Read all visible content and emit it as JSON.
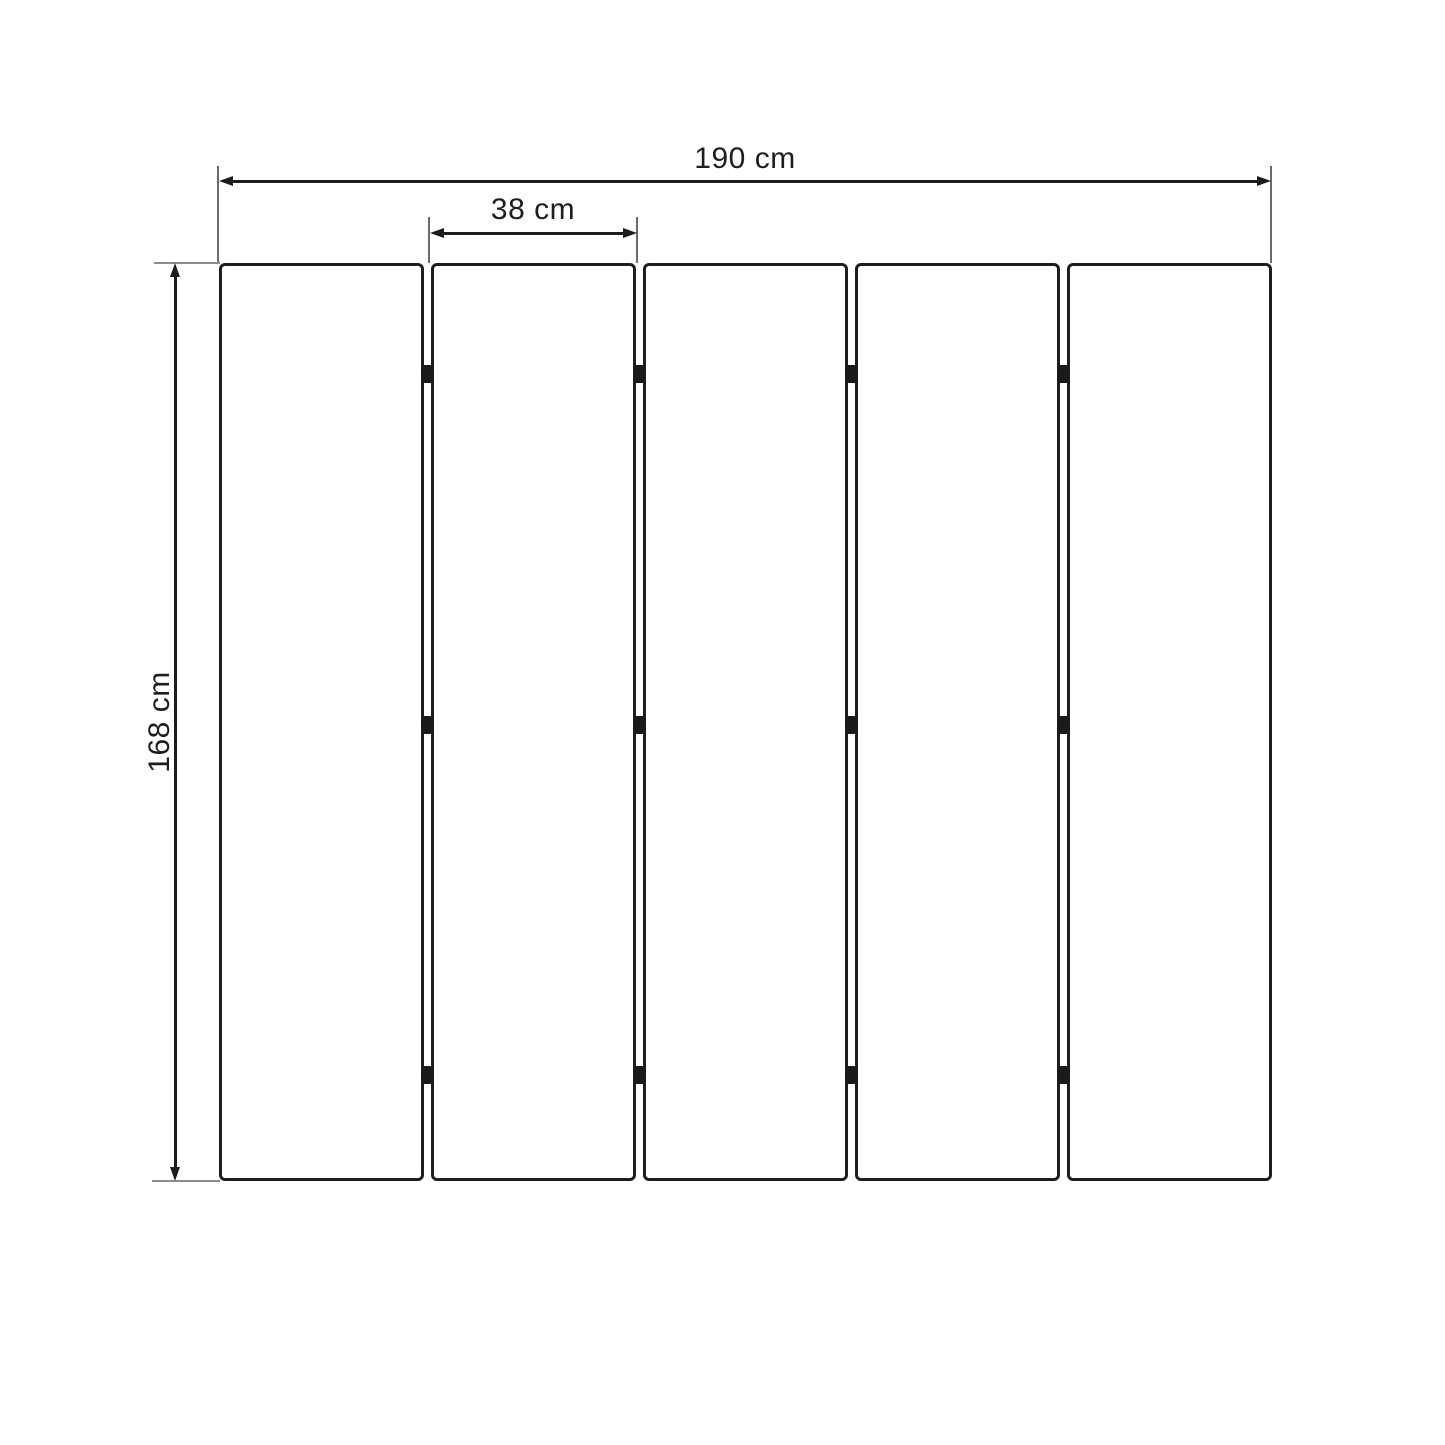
{
  "diagram": {
    "type": "panel-dimension-drawing",
    "labels": {
      "total_width": "190 cm",
      "panel_width": "38 cm",
      "total_height": "168 cm"
    },
    "panels": {
      "count": 5,
      "gaps": 4,
      "hinge_marks_per_gap": 3
    },
    "colors": {
      "dimension_line": "#1c1c1c",
      "extension_line": "#6b6b6b",
      "panel_border": "#1e1e1e",
      "panel_fill": "#ffffff",
      "hinge": "#1a1a1a",
      "text": "#1d1d1d",
      "background": "#ffffff"
    }
  }
}
